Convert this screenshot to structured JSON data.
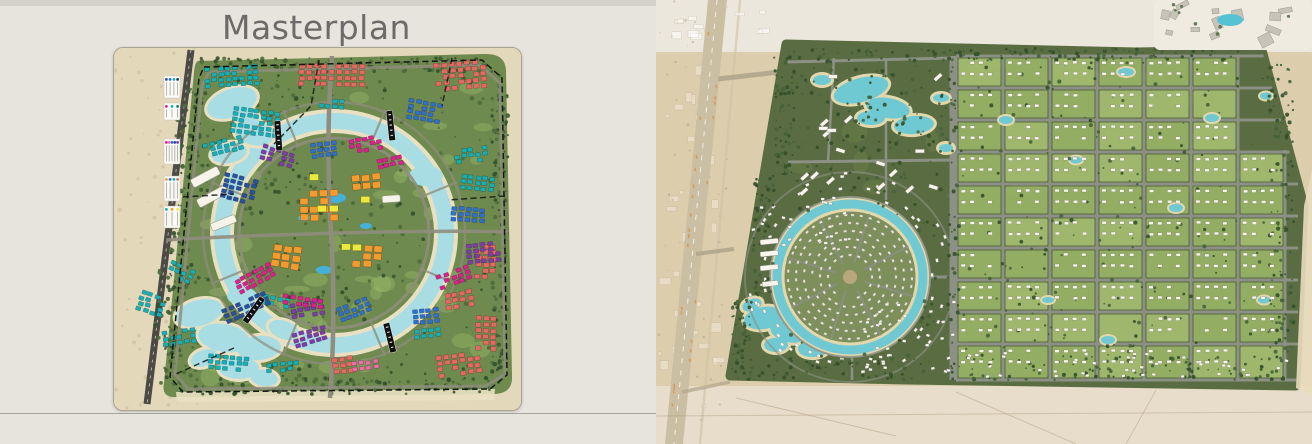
{
  "header": {
    "title": "Masterplan"
  },
  "left_map": {
    "palette": {
      "desert": "#e4d8bb",
      "desert_speckle": "#cdbc97",
      "road_dark": "#4c4a45",
      "green": "#6e8a4e",
      "grass_light": "#9cb86c",
      "tree_dark": "#31502c",
      "tree_dark2": "#3c5a31",
      "tree_mid": "#4e6b3c",
      "sand": "#e9e0c2",
      "water": "#a9dde4",
      "pool": "#43b3df",
      "road": "#8f8d7d",
      "boundary": "#161616",
      "buildings": {
        "teal": "#14b0b6",
        "red": "#e86760",
        "blue": "#2f6fd0",
        "navy": "#27519e",
        "purple": "#7d3ca8",
        "magenta": "#e01f8f",
        "pink": "#ee6ca8",
        "orange": "#f39b2d",
        "yellow": "#ede93c",
        "white": "#f6f3ea"
      }
    },
    "legend": {
      "groups": [
        {
          "y": 28,
          "h": 22,
          "dots": [
            "#27519e",
            "#2f6fd0",
            "#14b0b6",
            "#1d3a6e"
          ]
        },
        {
          "y": 55,
          "h": 17,
          "dots": [
            "#e01f8f",
            "#14b0b6",
            "#0e7d74"
          ]
        },
        {
          "y": 91,
          "h": 25,
          "dots": [
            "#e01f8f",
            "#ee6ca8",
            "#2f6fd0",
            "#27519e",
            "#7d3ca8"
          ]
        },
        {
          "y": 128,
          "h": 25,
          "dots": [
            "#f39b2d",
            "#2f6fd0",
            "#14b0b6",
            "#e86760"
          ]
        },
        {
          "y": 158,
          "h": 22,
          "dots": [
            "#14b0b6",
            "#f39b2d",
            "#ede93c"
          ]
        }
      ]
    },
    "phase_banners": [
      [
        160,
        73,
        -4
      ],
      [
        272,
        63,
        -6
      ],
      [
        146,
        248,
        36
      ],
      [
        269,
        276,
        -14
      ]
    ],
    "clusters": [
      [
        90,
        20,
        8,
        4,
        7,
        5.5,
        -4,
        "teal"
      ],
      [
        120,
        58,
        7,
        5,
        7,
        5.5,
        8,
        "teal"
      ],
      [
        88,
        96,
        6,
        3,
        7,
        5.5,
        -14,
        "teal"
      ],
      [
        205,
        50,
        4,
        2,
        7,
        5.5,
        5,
        "teal"
      ],
      [
        348,
        126,
        5,
        3,
        7,
        5.5,
        6,
        "teal"
      ],
      [
        340,
        102,
        5,
        3,
        7,
        5.5,
        -8,
        "teal"
      ],
      [
        28,
        242,
        4,
        4,
        7,
        5.5,
        18,
        "teal"
      ],
      [
        48,
        284,
        5,
        3,
        7,
        5.5,
        -8,
        "teal"
      ],
      [
        95,
        306,
        6,
        3,
        7,
        5.5,
        4,
        "teal"
      ],
      [
        152,
        316,
        5,
        2,
        7,
        5.5,
        -6,
        "teal"
      ],
      [
        58,
        212,
        4,
        3,
        7,
        5.5,
        26,
        "teal"
      ],
      [
        150,
        246,
        4,
        2,
        7,
        5.5,
        12,
        "teal"
      ],
      [
        300,
        282,
        4,
        2,
        7,
        5.5,
        -6,
        "teal"
      ],
      [
        185,
        16,
        9,
        4,
        7.5,
        6,
        0,
        "red"
      ],
      [
        320,
        16,
        7,
        5,
        7.5,
        6,
        -6,
        "red"
      ],
      [
        330,
        246,
        4,
        3,
        7.5,
        6,
        -10,
        "red"
      ],
      [
        322,
        308,
        6,
        4,
        7.5,
        6,
        -8,
        "red"
      ],
      [
        362,
        196,
        3,
        6,
        7.5,
        6,
        2,
        "red"
      ],
      [
        362,
        268,
        3,
        6,
        7.5,
        6,
        2,
        "red"
      ],
      [
        218,
        310,
        3,
        3,
        7.5,
        6,
        -6,
        "red"
      ],
      [
        296,
        50,
        5,
        4,
        7,
        5.5,
        10,
        "blue"
      ],
      [
        338,
        158,
        5,
        3,
        7,
        5.5,
        4,
        "blue"
      ],
      [
        196,
        96,
        4,
        3,
        7,
        5.5,
        -8,
        "blue"
      ],
      [
        112,
        124,
        5,
        5,
        7,
        5.5,
        14,
        "navy"
      ],
      [
        108,
        262,
        7,
        3,
        7,
        5.5,
        -24,
        "navy"
      ],
      [
        298,
        262,
        4,
        3,
        7,
        5.5,
        -5,
        "blue"
      ],
      [
        222,
        260,
        5,
        3,
        7,
        5.5,
        -20,
        "blue"
      ],
      [
        352,
        196,
        5,
        4,
        7,
        5.5,
        -6,
        "purple"
      ],
      [
        176,
        256,
        5,
        3,
        7,
        5.5,
        -8,
        "purple"
      ],
      [
        178,
        286,
        5,
        3,
        7,
        5.5,
        -16,
        "purple"
      ],
      [
        150,
        96,
        5,
        3,
        7,
        5.5,
        18,
        "purple"
      ],
      [
        234,
        92,
        5,
        3,
        7,
        5.5,
        -10,
        "magenta"
      ],
      [
        262,
        112,
        4,
        2,
        7,
        5.5,
        -12,
        "magenta"
      ],
      [
        120,
        233,
        6,
        3,
        7,
        5.5,
        -28,
        "magenta"
      ],
      [
        170,
        246,
        6,
        2,
        7,
        5.5,
        8,
        "magenta"
      ],
      [
        322,
        228,
        5,
        3,
        7,
        5.5,
        -20,
        "magenta"
      ],
      [
        238,
        314,
        4,
        2,
        7,
        5.5,
        -6,
        "pink"
      ],
      [
        186,
        142,
        4,
        4,
        10,
        8,
        0,
        "orange"
      ],
      [
        160,
        196,
        3,
        3,
        10,
        8,
        8,
        "orange"
      ],
      [
        238,
        128,
        3,
        2,
        10,
        8,
        -6,
        "orange"
      ],
      [
        240,
        196,
        3,
        3,
        10,
        8,
        4,
        "orange"
      ],
      [
        204,
        158,
        2,
        1,
        11,
        8,
        0,
        "yellow"
      ],
      [
        228,
        196,
        2,
        1,
        11,
        8,
        0,
        "yellow"
      ],
      [
        196,
        126,
        1,
        1,
        11,
        8,
        0,
        "yellow"
      ],
      [
        246,
        148,
        2,
        1,
        11,
        8,
        0,
        "yellow"
      ]
    ],
    "white_slabs": [
      [
        76,
        132,
        30,
        9,
        -28
      ],
      [
        82,
        152,
        32,
        9,
        -28
      ],
      [
        96,
        176,
        26,
        8,
        -22
      ],
      [
        268,
        148,
        18,
        7,
        -4
      ]
    ],
    "pools": [
      [
        222,
        150,
        10,
        5
      ],
      [
        210,
        222,
        8,
        4
      ],
      [
        252,
        178,
        6,
        3
      ],
      [
        190,
        170,
        6,
        3
      ]
    ],
    "lagoon_tl": [
      [
        118,
        55,
        26,
        14,
        -20
      ],
      [
        140,
        85,
        20,
        12,
        15
      ],
      [
        115,
        105,
        18,
        10,
        -10
      ],
      [
        132,
        68,
        14,
        9,
        30
      ]
    ],
    "lagoon_bl": [
      [
        85,
        265,
        24,
        13,
        -15
      ],
      [
        110,
        290,
        26,
        14,
        10
      ],
      [
        145,
        300,
        22,
        12,
        -5
      ],
      [
        170,
        282,
        16,
        9,
        20
      ],
      [
        125,
        320,
        20,
        11,
        0
      ],
      [
        90,
        310,
        14,
        8,
        -20
      ],
      [
        150,
        330,
        14,
        8,
        10
      ]
    ],
    "tree_regions": [
      [
        86,
        10,
        296,
        14,
        130
      ],
      [
        378,
        22,
        16,
        318,
        100
      ],
      [
        66,
        330,
        316,
        16,
        130
      ],
      [
        62,
        40,
        24,
        90,
        55
      ],
      [
        54,
        140,
        20,
        105,
        55
      ],
      [
        50,
        250,
        18,
        80,
        45
      ],
      [
        92,
        30,
        300,
        305,
        300
      ],
      [
        40,
        215,
        150,
        125,
        110
      ],
      [
        85,
        25,
        110,
        140,
        90
      ]
    ]
  },
  "right_map": {
    "palette": {
      "desert": "#dccdad",
      "desert_top": "#ece7dc",
      "desert_bottom": "#e8ddcb",
      "green": "#5a6c42",
      "green_light": "#728849",
      "road_main": "#cbbfa3",
      "road_mark": "#d79850",
      "road_g": "#8b9184",
      "block_a": "#a3bc6f",
      "block_b": "#97b165",
      "water": "#6fc9d3",
      "sand": "#e3d7ac",
      "house": "#f7f5ed",
      "tree_dark": "#33502a",
      "tree_mid": "#466339",
      "beach": "#e9ddbf",
      "resort": "#c6c3b8",
      "pool": "#55c3d4"
    },
    "grid": {
      "cols_x": [
        300,
        347,
        394,
        441,
        488,
        535,
        582,
        629
      ],
      "rows_y": [
        56,
        88,
        120,
        152,
        184,
        216,
        248,
        280,
        312,
        344,
        380
      ]
    },
    "ring": {
      "cx": 194,
      "cy": 277,
      "outer_r": 73
    },
    "lagoons_top": [
      [
        205,
        90,
        28,
        12,
        -15
      ],
      [
        232,
        108,
        22,
        10,
        10
      ],
      [
        258,
        125,
        20,
        9,
        -5
      ],
      [
        215,
        118,
        14,
        7,
        0
      ],
      [
        166,
        80,
        9,
        5,
        0
      ],
      [
        285,
        98,
        8,
        4,
        0
      ],
      [
        290,
        148,
        7,
        4,
        0
      ]
    ],
    "lagoons_bottom": [
      [
        108,
        318,
        20,
        11,
        -10
      ],
      [
        132,
        332,
        18,
        10,
        15
      ],
      [
        158,
        348,
        16,
        9,
        -5
      ],
      [
        120,
        345,
        12,
        7,
        0
      ],
      [
        96,
        305,
        10,
        6,
        -20
      ],
      [
        148,
        322,
        10,
        6,
        0
      ]
    ],
    "ponds": [
      [
        470,
        72,
        8,
        4
      ],
      [
        556,
        118,
        7,
        4
      ],
      [
        610,
        96,
        6,
        3.5
      ],
      [
        520,
        208,
        7,
        4
      ],
      [
        608,
        300,
        6,
        3.5
      ],
      [
        452,
        340,
        7,
        4
      ],
      [
        392,
        300,
        6,
        3
      ],
      [
        350,
        120,
        7,
        4
      ],
      [
        420,
        160,
        6,
        3.5
      ]
    ],
    "slab_column": [
      [
        104,
        240,
        18,
        5
      ],
      [
        104,
        252,
        18,
        5
      ],
      [
        104,
        266,
        18,
        5
      ],
      [
        106,
        282,
        16,
        5
      ]
    ],
    "house_scatter": [
      [
        95,
        195,
        95,
        55,
        25
      ],
      [
        205,
        300,
        100,
        70,
        35
      ],
      [
        310,
        352,
        320,
        24,
        40
      ]
    ],
    "tree_regions": [
      [
        132,
        48,
        470,
        12,
        130
      ],
      [
        612,
        60,
        26,
        320,
        110
      ],
      [
        78,
        356,
        556,
        24,
        150
      ],
      [
        118,
        56,
        20,
        120,
        70
      ],
      [
        96,
        176,
        22,
        120,
        70
      ],
      [
        76,
        296,
        20,
        80,
        55
      ],
      [
        140,
        60,
        155,
        135,
        140
      ],
      [
        130,
        200,
        150,
        168,
        150
      ],
      [
        300,
        60,
        336,
        320,
        220
      ],
      [
        292,
        58,
        10,
        324,
        45
      ]
    ]
  }
}
